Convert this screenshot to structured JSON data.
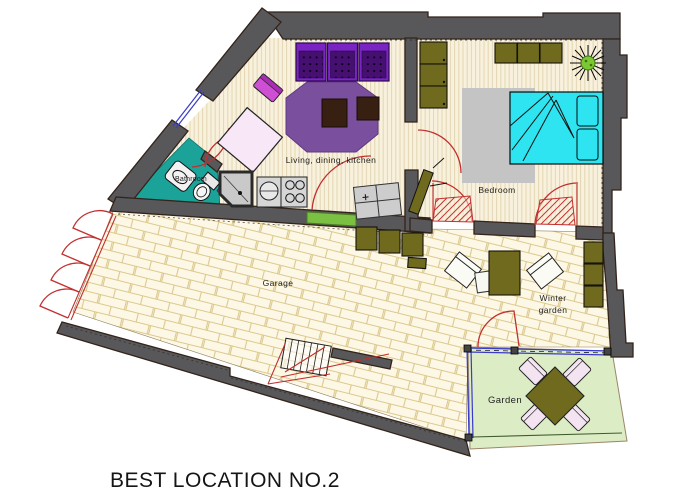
{
  "labels": {
    "living": "Living, dining, kitchen",
    "bedroom": "Bedroom",
    "bathroom": "Bathroom",
    "garage": "Garage",
    "winter_garden_1": "Winter",
    "winter_garden_2": "garden",
    "garden": "Garden",
    "title": "BEST LOCATION NO.2"
  },
  "palette": {
    "wall": "#58585a",
    "wall_outline": "#33231a",
    "wood_floor": "#f8f1dd",
    "wood_grain": "#cbb37f",
    "brick_floor": "#fdf8e6",
    "brick_line": "#dcc98e",
    "bathroom": "#1ba39a",
    "bed": "#2de4f0",
    "rug": "#c4c4c4",
    "sofa": "#7b24c4",
    "sofa_dark": "#45106f",
    "carpet": "#7a4f9e",
    "olive": "#6f6a1d",
    "garden": "#dcedc6",
    "door_arc": "#c23030",
    "fence_blue": "#3a3acc",
    "chair_magenta": "#cf4fd4",
    "table_pink": "#f7e7f7",
    "green_strip": "#7cc043",
    "plant_green": "#7cc832",
    "dark_square": "#371f12",
    "gray_fixture": "#cdcdcd",
    "text": "#222222"
  }
}
